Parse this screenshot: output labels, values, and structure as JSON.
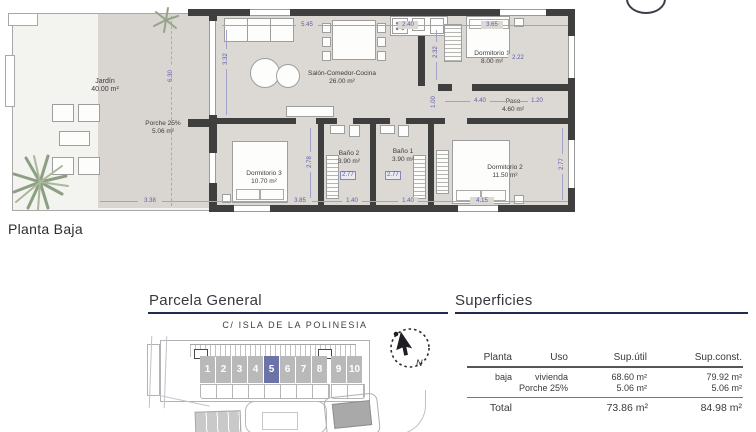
{
  "page": {
    "planta_label": "Planta Baja"
  },
  "plan": {
    "rooms": {
      "jardin": {
        "name": "Jardín",
        "area": "40.00 m²"
      },
      "porche": {
        "name": "Porche 25%",
        "area": "5.06 m²"
      },
      "salon": {
        "name": "Salón-Comedor-Cocina",
        "area": "26.00 m²"
      },
      "dorm1": {
        "name": "Dormitorio 1",
        "area": "8.00 m²"
      },
      "paso": {
        "name": "Paso",
        "area": "4.60 m²"
      },
      "dorm3": {
        "name": "Dormitorio 3",
        "area": "10.70 m²"
      },
      "bano2": {
        "name": "Baño 2",
        "area": "3.90 m²"
      },
      "bano1": {
        "name": "Baño 1",
        "area": "3.90 m²"
      },
      "dorm2": {
        "name": "Dormitorio 2",
        "area": "11.50 m²"
      }
    },
    "dims": {
      "salon_top": "5.45",
      "kitchen_top": "2.40",
      "dorm1_top": "3.65",
      "salon_left": "3.32",
      "kitchen_right": "2.32",
      "dorm1_inner": "2.22",
      "porche_height": "6.30",
      "paso_width": "4.40",
      "paso_right": "1.20",
      "paso_left": "1.00",
      "dorm3_height": "2.78",
      "dorm2_height": "2.77",
      "bano2_box": "2.77",
      "bano1_box": "2.77",
      "porche_bottom": "3.38",
      "dorm3_bottom": "3.85",
      "bano2_bottom": "1.40",
      "bano1_bottom": "1.40",
      "dorm2_bottom": "4.15"
    }
  },
  "parcela": {
    "title": "Parcela General",
    "street": "C/ ISLA DE LA POLINESIA",
    "plots": [
      "1",
      "2",
      "3",
      "4",
      "5",
      "6",
      "7",
      "8",
      "9",
      "10"
    ],
    "highlighted_plot": "5",
    "compass_label": "N"
  },
  "superficies": {
    "title": "Superficies",
    "header": [
      "Planta",
      "Uso",
      "Sup.útil",
      "Sup.const."
    ],
    "rows": [
      {
        "planta": "baja",
        "uso": "vivienda",
        "util": "68.60 m²",
        "const": "79.92 m²"
      },
      {
        "planta": "",
        "uso": "Porche 25%",
        "util": "5.06 m²",
        "const": "5.06 m²"
      }
    ],
    "total": {
      "label": "Total",
      "util": "73.86 m²",
      "const": "84.98 m²"
    }
  },
  "colors": {
    "accent_navy": "#232a52",
    "plot_highlight": "#6b73a8",
    "wall": "#3f3f3f",
    "floor": "#dcd8d3",
    "dimension_blue": "#5b5bb0"
  }
}
